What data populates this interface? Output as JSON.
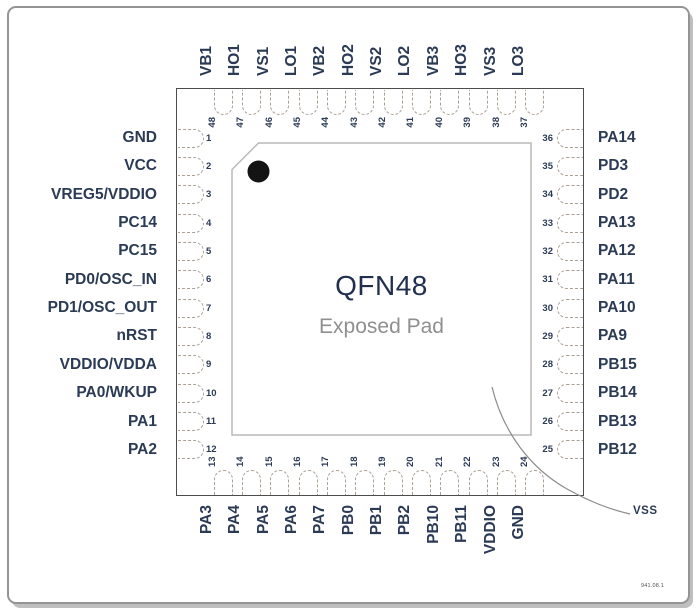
{
  "figure": {
    "package_label": "QFN48",
    "pad_label": "Exposed Pad",
    "vss_label": "VSS",
    "footer_code": "941.08.1"
  },
  "colors": {
    "label_navy": "#2b3a55",
    "chip_line": "#4d4d4d",
    "pad_line": "#b8b8b8",
    "pin_dash": "#ab9f94",
    "pad_text_gray": "#8f8f8f",
    "marker_dot": "#141414"
  },
  "pins": {
    "top": [
      {
        "num": 48,
        "label": "VB1"
      },
      {
        "num": 47,
        "label": "HO1"
      },
      {
        "num": 46,
        "label": "VS1"
      },
      {
        "num": 45,
        "label": "LO1"
      },
      {
        "num": 44,
        "label": "VB2"
      },
      {
        "num": 43,
        "label": "HO2"
      },
      {
        "num": 42,
        "label": "VS2"
      },
      {
        "num": 41,
        "label": "LO2"
      },
      {
        "num": 40,
        "label": "VB3"
      },
      {
        "num": 39,
        "label": "HO3"
      },
      {
        "num": 38,
        "label": "VS3"
      },
      {
        "num": 37,
        "label": "LO3"
      }
    ],
    "left": [
      {
        "num": 1,
        "label": "GND"
      },
      {
        "num": 2,
        "label": "VCC"
      },
      {
        "num": 3,
        "label": "VREG5/VDDIO"
      },
      {
        "num": 4,
        "label": "PC14"
      },
      {
        "num": 5,
        "label": "PC15"
      },
      {
        "num": 6,
        "label": "PD0/OSC_IN"
      },
      {
        "num": 7,
        "label": "PD1/OSC_OUT"
      },
      {
        "num": 8,
        "label": "nRST"
      },
      {
        "num": 9,
        "label": "VDDIO/VDDA"
      },
      {
        "num": 10,
        "label": "PA0/WKUP"
      },
      {
        "num": 11,
        "label": "PA1"
      },
      {
        "num": 12,
        "label": "PA2"
      }
    ],
    "right": [
      {
        "num": 36,
        "label": "PA14"
      },
      {
        "num": 35,
        "label": "PD3"
      },
      {
        "num": 34,
        "label": "PD2"
      },
      {
        "num": 33,
        "label": "PA13"
      },
      {
        "num": 32,
        "label": "PA12"
      },
      {
        "num": 31,
        "label": "PA11"
      },
      {
        "num": 30,
        "label": "PA10"
      },
      {
        "num": 29,
        "label": "PA9"
      },
      {
        "num": 28,
        "label": "PB15"
      },
      {
        "num": 27,
        "label": "PB14"
      },
      {
        "num": 26,
        "label": "PB13"
      },
      {
        "num": 25,
        "label": "PB12"
      }
    ],
    "bottom": [
      {
        "num": 13,
        "label": "PA3"
      },
      {
        "num": 14,
        "label": "PA4"
      },
      {
        "num": 15,
        "label": "PA5"
      },
      {
        "num": 16,
        "label": "PA6"
      },
      {
        "num": 17,
        "label": "PA7"
      },
      {
        "num": 18,
        "label": "PB0"
      },
      {
        "num": 19,
        "label": "PB1"
      },
      {
        "num": 20,
        "label": "PB2"
      },
      {
        "num": 21,
        "label": "PB10"
      },
      {
        "num": 22,
        "label": "PB11"
      },
      {
        "num": 23,
        "label": "VDDIO"
      },
      {
        "num": 24,
        "label": "GND"
      }
    ]
  }
}
